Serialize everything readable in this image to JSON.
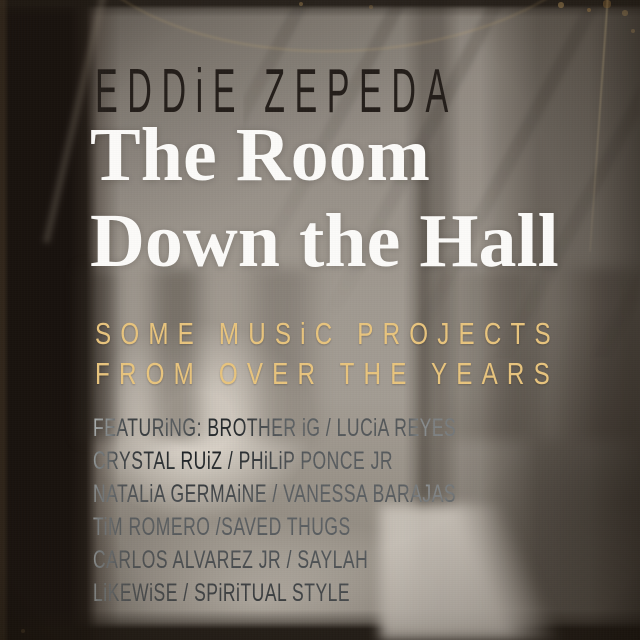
{
  "cover": {
    "scene": "blurred sepia-toned hallway photograph with doorways receding to a bright corridor end, aged film scratches and vignette",
    "artist": "EDDiE ZEPEDA",
    "title_line1": "The Room",
    "title_line2": "Down the Hall",
    "subtitle_line1": "SOME MUSiC PROJECTS",
    "subtitle_line2": "FROM OVER THE YEARS",
    "credits": [
      "FEATURiNG: BROTHER iG / LUCiA REYES",
      "CRYSTAL RUiZ / PHiLiP PONCE JR",
      "NATALiA GERMAiNE / VANESSA BARAJAS",
      "TiM ROMERO /SAVED THUGS",
      "CARLOS ALVAREZ JR / SAYLAH",
      "LiKEWiSE / SPiRiTUAL STYLE"
    ],
    "colors": {
      "artist_text": "#241e1a",
      "title_text": "#fcfbf9",
      "subtitle_gold": "#e9c57e",
      "left_band": "#18120e",
      "wall_gray": "#a8a29a"
    }
  }
}
